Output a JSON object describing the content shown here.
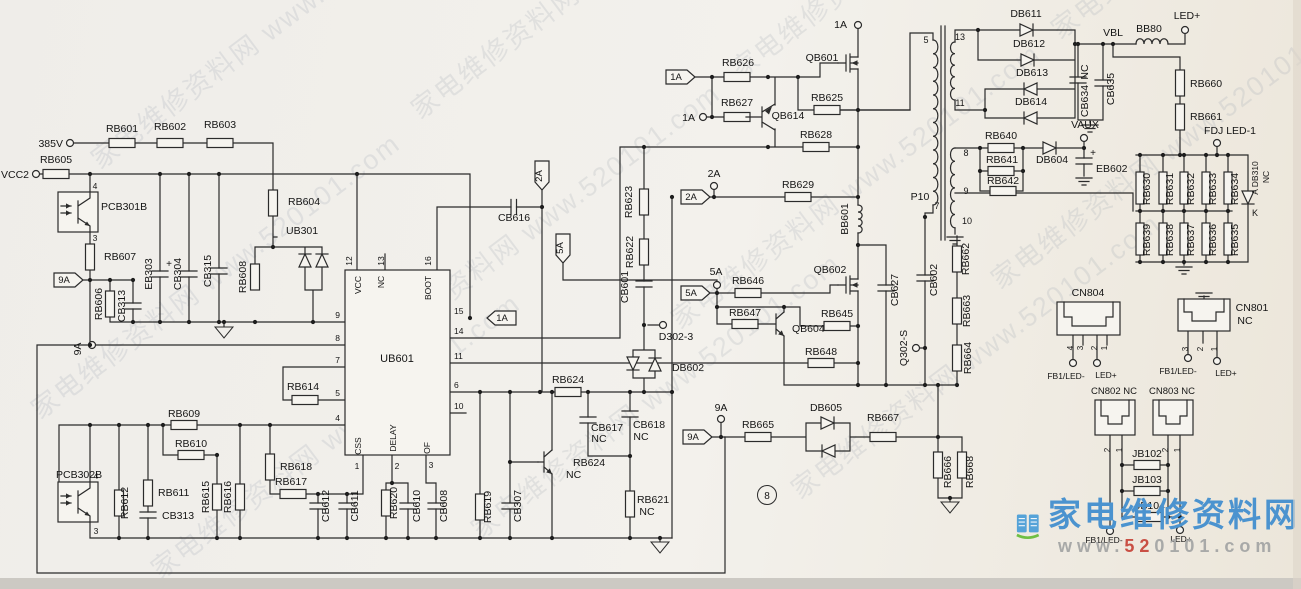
{
  "watermark": {
    "tile": "家电维修资料网 www.520101.com"
  },
  "logo": {
    "site_name": "家电维修资料网",
    "url_prefix": "www.",
    "url_accent": "52",
    "url_suffix": "0101.com",
    "icon": "open-book-icon"
  },
  "page_marker": "8",
  "colors": {
    "ink": "#2b2b2b",
    "paper": "#f3f1ec",
    "logo_blue": "#4b93cf",
    "logo_green": "#6fbf44",
    "logo_red": "#c94f44",
    "watermark": "#8b95a5"
  },
  "labels": [
    {
      "id": "net-385v",
      "t": "385V",
      "x": 63,
      "y": 147,
      "a": "end"
    },
    {
      "id": "net-vcc2",
      "t": "VCC2",
      "x": 29,
      "y": 178,
      "a": "end"
    },
    {
      "id": "net-9a-left",
      "t": "9A",
      "x": 81,
      "y": 349,
      "r": -90
    },
    {
      "id": "flag-1a",
      "t": "1A",
      "x": 676,
      "y": 80,
      "fs": 9.5
    },
    {
      "id": "net-1a-gate",
      "t": "1A",
      "x": 695,
      "y": 121,
      "a": "end"
    },
    {
      "id": "net-1a-top",
      "t": "1A",
      "x": 847,
      "y": 28,
      "a": "end"
    },
    {
      "id": "flag-2a",
      "t": "2A",
      "x": 691,
      "y": 200,
      "fs": 9.5
    },
    {
      "id": "net-2a",
      "t": "2A",
      "x": 714,
      "y": 177
    },
    {
      "id": "flag-2a-down",
      "t": "2A",
      "x": 542,
      "y": 176,
      "r": -90,
      "fs": 9.5
    },
    {
      "id": "flag-5a-down",
      "t": "5A",
      "x": 563,
      "y": 248,
      "r": -90,
      "fs": 9.5
    },
    {
      "id": "flag-5a",
      "t": "5A",
      "x": 691,
      "y": 296,
      "fs": 9.5
    },
    {
      "id": "net-5a",
      "t": "5A",
      "x": 716,
      "y": 275
    },
    {
      "id": "flag-9a-top",
      "t": "9A",
      "x": 64,
      "y": 283,
      "fs": 9.5
    },
    {
      "id": "flag-9a-mid",
      "t": "9A",
      "x": 693,
      "y": 440,
      "fs": 9.5
    },
    {
      "id": "net-9a-mid",
      "t": "9A",
      "x": 721,
      "y": 411
    },
    {
      "id": "flag-1a-pin15",
      "t": "1A",
      "x": 502,
      "y": 321,
      "fs": 9.5
    },
    {
      "id": "net-d302-3",
      "t": "D302-3",
      "x": 676,
      "y": 340
    },
    {
      "id": "net-q302-s",
      "t": "Q302-S",
      "x": 907,
      "y": 348,
      "r": -90
    },
    {
      "id": "net-vaux",
      "t": "VAUX",
      "x": 1085,
      "y": 128
    },
    {
      "id": "net-led-plus-top",
      "t": "LED+",
      "x": 1187,
      "y": 19
    },
    {
      "id": "net-fdj-led1",
      "t": "FDJ LED-1",
      "x": 1230,
      "y": 134
    },
    {
      "id": "net-vbl",
      "t": "VBL",
      "x": 1113,
      "y": 36
    },
    {
      "id": "page-marker",
      "t": "8",
      "x": 767,
      "y": 499,
      "fs": 10
    },
    {
      "id": "rb601",
      "t": "RB601",
      "x": 122,
      "y": 132
    },
    {
      "id": "rb602",
      "t": "RB602",
      "x": 170,
      "y": 130
    },
    {
      "id": "rb603",
      "t": "RB603",
      "x": 220,
      "y": 128
    },
    {
      "id": "rb605",
      "t": "RB605",
      "x": 56,
      "y": 163
    },
    {
      "id": "pcb301b",
      "t": "PCB301B",
      "x": 101,
      "y": 210,
      "a": "start"
    },
    {
      "id": "opto1-pin4",
      "t": "4",
      "x": 95,
      "y": 189,
      "fs": 8.5
    },
    {
      "id": "opto1-pin3",
      "t": "3",
      "x": 95,
      "y": 241,
      "fs": 8.5
    },
    {
      "id": "rb607",
      "t": "RB607",
      "x": 104,
      "y": 260,
      "a": "start"
    },
    {
      "id": "rb604",
      "t": "RB604",
      "x": 288,
      "y": 205,
      "a": "start"
    },
    {
      "id": "ub301",
      "t": "UB301",
      "x": 286,
      "y": 234,
      "a": "start"
    },
    {
      "id": "eb303",
      "t": "EB303",
      "x": 152,
      "y": 274,
      "r": -90
    },
    {
      "id": "eb303-plus",
      "t": "+",
      "x": 169,
      "y": 267,
      "fs": 10
    },
    {
      "id": "cb304",
      "t": "CB304",
      "x": 181,
      "y": 274,
      "r": -90
    },
    {
      "id": "cb315",
      "t": "CB315",
      "x": 211,
      "y": 271,
      "r": -90
    },
    {
      "id": "rb608",
      "t": "RB608",
      "x": 246,
      "y": 277,
      "r": -90
    },
    {
      "id": "rb606",
      "t": "RB606",
      "x": 102,
      "y": 304,
      "r": -90
    },
    {
      "id": "cb313-1",
      "t": "CB313",
      "x": 125,
      "y": 306,
      "r": -90
    },
    {
      "id": "rb609",
      "t": "RB609",
      "x": 184,
      "y": 417
    },
    {
      "id": "rb610",
      "t": "RB610",
      "x": 191,
      "y": 447
    },
    {
      "id": "rb614",
      "t": "RB614",
      "x": 303,
      "y": 390
    },
    {
      "id": "rb618",
      "t": "RB618",
      "x": 280,
      "y": 470,
      "a": "start"
    },
    {
      "id": "rb617",
      "t": "RB617",
      "x": 291,
      "y": 485
    },
    {
      "id": "pcb302b",
      "t": "PCB302B",
      "x": 56,
      "y": 478,
      "a": "start"
    },
    {
      "id": "opto2-pin4",
      "t": "4",
      "x": 96,
      "y": 479,
      "fs": 8.5
    },
    {
      "id": "opto2-pin3",
      "t": "3",
      "x": 96,
      "y": 534,
      "fs": 8.5
    },
    {
      "id": "rb612",
      "t": "RB612",
      "x": 128,
      "y": 503,
      "r": -90
    },
    {
      "id": "rb611",
      "t": "RB611",
      "x": 158,
      "y": 496,
      "a": "start"
    },
    {
      "id": "cb313-2",
      "t": "CB313",
      "x": 162,
      "y": 519,
      "a": "start"
    },
    {
      "id": "rb615",
      "t": "RB615",
      "x": 209,
      "y": 497,
      "r": -90
    },
    {
      "id": "rb616",
      "t": "RB616",
      "x": 231,
      "y": 497,
      "r": -90
    },
    {
      "id": "cb612",
      "t": "CB612",
      "x": 329,
      "y": 506,
      "r": -90
    },
    {
      "id": "cb611",
      "t": "CB611",
      "x": 358,
      "y": 506,
      "r": -90
    },
    {
      "id": "rb620",
      "t": "RB620",
      "x": 397,
      "y": 503,
      "r": -90
    },
    {
      "id": "cb610",
      "t": "CB610",
      "x": 420,
      "y": 506,
      "r": -90
    },
    {
      "id": "cb608",
      "t": "CB608",
      "x": 447,
      "y": 506,
      "r": -90
    },
    {
      "id": "rb619",
      "t": "RB619",
      "x": 491,
      "y": 507,
      "r": -90
    },
    {
      "id": "cb307",
      "t": "CB307",
      "x": 521,
      "y": 506,
      "r": -90
    },
    {
      "id": "qb624-label",
      "t": "RB624",
      "x": 573,
      "y": 466,
      "a": "start"
    },
    {
      "id": "qb624-nc",
      "t": "NC",
      "x": 566,
      "y": 478,
      "a": "start"
    },
    {
      "id": "cb617",
      "t": "CB617",
      "x": 607,
      "y": 431
    },
    {
      "id": "cb617-nc",
      "t": "NC",
      "x": 599,
      "y": 442
    },
    {
      "id": "cb618",
      "t": "CB618",
      "x": 649,
      "y": 428
    },
    {
      "id": "cb618-nc",
      "t": "NC",
      "x": 641,
      "y": 440
    },
    {
      "id": "rb621",
      "t": "RB621",
      "x": 653,
      "y": 503
    },
    {
      "id": "rb621-nc",
      "t": "NC",
      "x": 647,
      "y": 515
    },
    {
      "id": "rb624",
      "t": "RB624",
      "x": 568,
      "y": 383
    },
    {
      "id": "rb622",
      "t": "RB622",
      "x": 633,
      "y": 252,
      "r": -90
    },
    {
      "id": "rb623",
      "t": "RB623",
      "x": 632,
      "y": 202,
      "r": -90
    },
    {
      "id": "cb601",
      "t": "CB601",
      "x": 628,
      "y": 287,
      "r": -90
    },
    {
      "id": "db602",
      "t": "DB602",
      "x": 688,
      "y": 371
    },
    {
      "id": "rb626",
      "t": "RB626",
      "x": 738,
      "y": 66
    },
    {
      "id": "rb627",
      "t": "RB627",
      "x": 737,
      "y": 106
    },
    {
      "id": "qb614",
      "t": "QB614",
      "x": 788,
      "y": 119
    },
    {
      "id": "qb601",
      "t": "QB601",
      "x": 822,
      "y": 61
    },
    {
      "id": "rb625",
      "t": "RB625",
      "x": 827,
      "y": 101
    },
    {
      "id": "rb628",
      "t": "RB628",
      "x": 816,
      "y": 138
    },
    {
      "id": "rb629",
      "t": "RB629",
      "x": 798,
      "y": 188
    },
    {
      "id": "rb646",
      "t": "RB646",
      "x": 748,
      "y": 284
    },
    {
      "id": "rb647",
      "t": "RB647",
      "x": 745,
      "y": 316
    },
    {
      "id": "rb645",
      "t": "RB645",
      "x": 837,
      "y": 317
    },
    {
      "id": "rb648",
      "t": "RB648",
      "x": 821,
      "y": 355
    },
    {
      "id": "qb602",
      "t": "QB602",
      "x": 830,
      "y": 273
    },
    {
      "id": "qb604",
      "t": "QB604",
      "x": 792,
      "y": 332,
      "a": "start"
    },
    {
      "id": "bb601",
      "t": "BB601",
      "x": 848,
      "y": 219,
      "r": -90
    },
    {
      "id": "p10",
      "t": "P10",
      "x": 920,
      "y": 200
    },
    {
      "id": "cb627",
      "t": "CB627",
      "x": 898,
      "y": 290,
      "r": -90
    },
    {
      "id": "cb602",
      "t": "CB602",
      "x": 937,
      "y": 280,
      "r": -90
    },
    {
      "id": "rb662",
      "t": "RB662",
      "x": 969,
      "y": 259,
      "r": -90
    },
    {
      "id": "rb663",
      "t": "RB663",
      "x": 970,
      "y": 311,
      "r": -90
    },
    {
      "id": "rb664",
      "t": "RB664",
      "x": 971,
      "y": 358,
      "r": -90
    },
    {
      "id": "db605",
      "t": "DB605",
      "x": 826,
      "y": 411
    },
    {
      "id": "rb667",
      "t": "RB667",
      "x": 883,
      "y": 421
    },
    {
      "id": "rb665",
      "t": "RB665",
      "x": 758,
      "y": 428
    },
    {
      "id": "rb666",
      "t": "RB666",
      "x": 951,
      "y": 472,
      "r": -90
    },
    {
      "id": "rb668",
      "t": "RB668",
      "x": 973,
      "y": 472,
      "r": -90
    },
    {
      "id": "xfmr-pin5",
      "t": "5",
      "x": 926,
      "y": 43,
      "fs": 9
    },
    {
      "id": "xfmr-pin7",
      "t": "7",
      "x": 937,
      "y": 209,
      "fs": 9
    },
    {
      "id": "xfmr-pin13",
      "t": "13",
      "x": 960,
      "y": 40,
      "fs": 9
    },
    {
      "id": "xfmr-pin11",
      "t": "11",
      "x": 960,
      "y": 106,
      "fs": 9
    },
    {
      "id": "xfmr-pin8",
      "t": "8",
      "x": 966,
      "y": 156,
      "fs": 9
    },
    {
      "id": "xfmr-pin9",
      "t": "9",
      "x": 966,
      "y": 194,
      "fs": 9
    },
    {
      "id": "xfmr-pin10",
      "t": "10",
      "x": 967,
      "y": 224,
      "fs": 9
    },
    {
      "id": "db611",
      "t": "DB611",
      "x": 1026,
      "y": 17
    },
    {
      "id": "db612",
      "t": "DB612",
      "x": 1029,
      "y": 47
    },
    {
      "id": "db613",
      "t": "DB613",
      "x": 1032,
      "y": 76
    },
    {
      "id": "db614",
      "t": "DB614",
      "x": 1031,
      "y": 105
    },
    {
      "id": "rb640",
      "t": "RB640",
      "x": 1001,
      "y": 139
    },
    {
      "id": "rb641",
      "t": "RB641",
      "x": 1002,
      "y": 163
    },
    {
      "id": "rb642",
      "t": "RB642",
      "x": 1003,
      "y": 184
    },
    {
      "id": "db604",
      "t": "DB604",
      "x": 1052,
      "y": 163
    },
    {
      "id": "eb602-plus",
      "t": "+",
      "x": 1093,
      "y": 156,
      "fs": 10
    },
    {
      "id": "eb602",
      "t": "EB602",
      "x": 1096,
      "y": 172,
      "a": "start"
    },
    {
      "id": "cb634",
      "t": "CB634",
      "x": 1088,
      "y": 101,
      "r": -90
    },
    {
      "id": "cb634-nc",
      "t": "NC",
      "x": 1088,
      "y": 72,
      "r": -90
    },
    {
      "id": "cb635",
      "t": "CB635",
      "x": 1114,
      "y": 89,
      "r": -90
    },
    {
      "id": "bb80",
      "t": "BB80",
      "x": 1149,
      "y": 32
    },
    {
      "id": "rb660",
      "t": "RB660",
      "x": 1190,
      "y": 87,
      "a": "start"
    },
    {
      "id": "rb661",
      "t": "RB661",
      "x": 1190,
      "y": 120,
      "a": "start"
    },
    {
      "id": "rb630",
      "t": "RB630",
      "x": 1150,
      "y": 189,
      "r": -90
    },
    {
      "id": "rb631",
      "t": "RB631",
      "x": 1173,
      "y": 189,
      "r": -90
    },
    {
      "id": "rb632",
      "t": "RB632",
      "x": 1194,
      "y": 189,
      "r": -90
    },
    {
      "id": "rb633",
      "t": "RB633",
      "x": 1216,
      "y": 189,
      "r": -90
    },
    {
      "id": "rb634",
      "t": "RB634",
      "x": 1238,
      "y": 189,
      "r": -90
    },
    {
      "id": "rb639",
      "t": "RB639",
      "x": 1150,
      "y": 240,
      "r": -90
    },
    {
      "id": "rb638",
      "t": "RB638",
      "x": 1173,
      "y": 240,
      "r": -90
    },
    {
      "id": "rb637",
      "t": "RB637",
      "x": 1194,
      "y": 240,
      "r": -90
    },
    {
      "id": "rb636",
      "t": "RB636",
      "x": 1216,
      "y": 240,
      "r": -90
    },
    {
      "id": "rb635",
      "t": "RB635",
      "x": 1238,
      "y": 240,
      "r": -90
    },
    {
      "id": "db310-a",
      "t": "A DB310",
      "x": 1258,
      "y": 178,
      "r": -90,
      "fs": 8.5
    },
    {
      "id": "db310-nc",
      "t": "NC",
      "x": 1269,
      "y": 177,
      "r": -90,
      "fs": 8.5
    },
    {
      "id": "db310-k",
      "t": "K",
      "x": 1255,
      "y": 216,
      "fs": 9
    },
    {
      "id": "cn804",
      "t": "CN804",
      "x": 1088,
      "y": 296
    },
    {
      "id": "cn804-pin4",
      "t": "4",
      "x": 1073,
      "y": 348,
      "r": -90,
      "fs": 8
    },
    {
      "id": "cn804-pin3",
      "t": "3",
      "x": 1083,
      "y": 348,
      "r": -90,
      "fs": 8
    },
    {
      "id": "cn804-pin2",
      "t": "2",
      "x": 1097,
      "y": 348,
      "r": -90,
      "fs": 8
    },
    {
      "id": "cn804-pin1",
      "t": "1",
      "x": 1107,
      "y": 348,
      "r": -90,
      "fs": 8
    },
    {
      "id": "cn804-fb1",
      "t": "FB1/LED-",
      "x": 1066,
      "y": 379,
      "fs": 8.5
    },
    {
      "id": "cn804-led",
      "t": "LED+",
      "x": 1106,
      "y": 378,
      "fs": 8.5
    },
    {
      "id": "cn801",
      "t": "CN801",
      "x": 1252,
      "y": 311
    },
    {
      "id": "cn801-nc",
      "t": "NC",
      "x": 1245,
      "y": 324
    },
    {
      "id": "cn801-pin3",
      "t": "3",
      "x": 1188,
      "y": 349,
      "r": -90,
      "fs": 8
    },
    {
      "id": "cn801-pin2",
      "t": "2",
      "x": 1203,
      "y": 349,
      "r": -90,
      "fs": 8
    },
    {
      "id": "cn801-pin1",
      "t": "1",
      "x": 1217,
      "y": 349,
      "r": -90,
      "fs": 8
    },
    {
      "id": "cn801-fb1",
      "t": "FB1/LED-",
      "x": 1178,
      "y": 374,
      "fs": 8.5
    },
    {
      "id": "cn801-led",
      "t": "LED+",
      "x": 1226,
      "y": 376,
      "fs": 8.5
    },
    {
      "id": "cn802",
      "t": "CN802 NC",
      "x": 1114,
      "y": 394,
      "fs": 9.5
    },
    {
      "id": "cn803",
      "t": "CN803 NC",
      "x": 1172,
      "y": 394,
      "fs": 9.5
    },
    {
      "id": "cn802-pin2",
      "t": "2",
      "x": 1110,
      "y": 450,
      "r": -90,
      "fs": 8
    },
    {
      "id": "cn802-pin1",
      "t": "1",
      "x": 1122,
      "y": 450,
      "r": -90,
      "fs": 8
    },
    {
      "id": "cn803-pin2",
      "t": "2",
      "x": 1168,
      "y": 450,
      "r": -90,
      "fs": 8
    },
    {
      "id": "cn803-pin1",
      "t": "1",
      "x": 1180,
      "y": 450,
      "r": -90,
      "fs": 8
    },
    {
      "id": "jb102",
      "t": "JB102",
      "x": 1147,
      "y": 457
    },
    {
      "id": "jb103",
      "t": "JB103",
      "x": 1147,
      "y": 483
    },
    {
      "id": "jb104",
      "t": "JB104",
      "x": 1150,
      "y": 509
    },
    {
      "id": "bot-fb1",
      "t": "FB1/LED-",
      "x": 1104,
      "y": 543,
      "fs": 8.5
    },
    {
      "id": "bot-led",
      "t": "LED+",
      "x": 1181,
      "y": 542,
      "fs": 8.5
    },
    {
      "id": "ub601",
      "t": "UB601",
      "x": 397,
      "y": 362,
      "fs": 11
    },
    {
      "id": "ic-pin12",
      "t": "12",
      "x": 352,
      "y": 261,
      "r": -90,
      "fs": 8.5
    },
    {
      "id": "ic-pin13",
      "t": "13",
      "x": 384,
      "y": 261,
      "r": -90,
      "fs": 8.5
    },
    {
      "id": "ic-pin16",
      "t": "16",
      "x": 431,
      "y": 261,
      "r": -90,
      "fs": 8.5
    },
    {
      "id": "ic-vcc",
      "t": "VCC",
      "x": 361,
      "y": 285,
      "r": -90,
      "fs": 8.5
    },
    {
      "id": "ic-nc",
      "t": "NC",
      "x": 384,
      "y": 282,
      "r": -90,
      "fs": 8.5
    },
    {
      "id": "ic-boot",
      "t": "BOOT",
      "x": 431,
      "y": 288,
      "r": -90,
      "fs": 8.5
    },
    {
      "id": "ic-pin9",
      "t": "9",
      "x": 340,
      "y": 318,
      "a": "end",
      "fs": 8.5
    },
    {
      "id": "ic-pin8",
      "t": "8",
      "x": 340,
      "y": 341,
      "a": "end",
      "fs": 8.5
    },
    {
      "id": "ic-pin7",
      "t": "7",
      "x": 340,
      "y": 363,
      "a": "end",
      "fs": 8.5
    },
    {
      "id": "ic-pin5",
      "t": "5",
      "x": 340,
      "y": 396,
      "a": "end",
      "fs": 8.5
    },
    {
      "id": "ic-pin4",
      "t": "4",
      "x": 340,
      "y": 421,
      "a": "end",
      "fs": 8.5
    },
    {
      "id": "ic-pin15",
      "t": "15",
      "x": 454,
      "y": 314,
      "a": "start",
      "fs": 8.5
    },
    {
      "id": "ic-pin14",
      "t": "14",
      "x": 454,
      "y": 334,
      "a": "start",
      "fs": 8.5
    },
    {
      "id": "ic-pin11",
      "t": "11",
      "x": 454,
      "y": 359,
      "a": "start",
      "fs": 8.5
    },
    {
      "id": "ic-pin6",
      "t": "6",
      "x": 454,
      "y": 388,
      "a": "start",
      "fs": 8.5
    },
    {
      "id": "ic-pin10",
      "t": "10",
      "x": 454,
      "y": 409,
      "a": "start",
      "fs": 8.5
    },
    {
      "id": "ic-pin1",
      "t": "1",
      "x": 357,
      "y": 469,
      "fs": 8.5
    },
    {
      "id": "ic-pin2",
      "t": "2",
      "x": 397,
      "y": 469,
      "fs": 8.5
    },
    {
      "id": "ic-pin3",
      "t": "3",
      "x": 431,
      "y": 468,
      "fs": 8.5
    },
    {
      "id": "ic-css",
      "t": "CSS",
      "x": 361,
      "y": 446,
      "r": -90,
      "fs": 8.5
    },
    {
      "id": "ic-delay",
      "t": "DELAY",
      "x": 396,
      "y": 438,
      "r": -90,
      "fs": 8.5
    },
    {
      "id": "ic-of",
      "t": "OF",
      "x": 430,
      "y": 448,
      "r": -90,
      "fs": 8.5
    },
    {
      "id": "cb616",
      "t": "CB616",
      "x": 514,
      "y": 221
    }
  ]
}
